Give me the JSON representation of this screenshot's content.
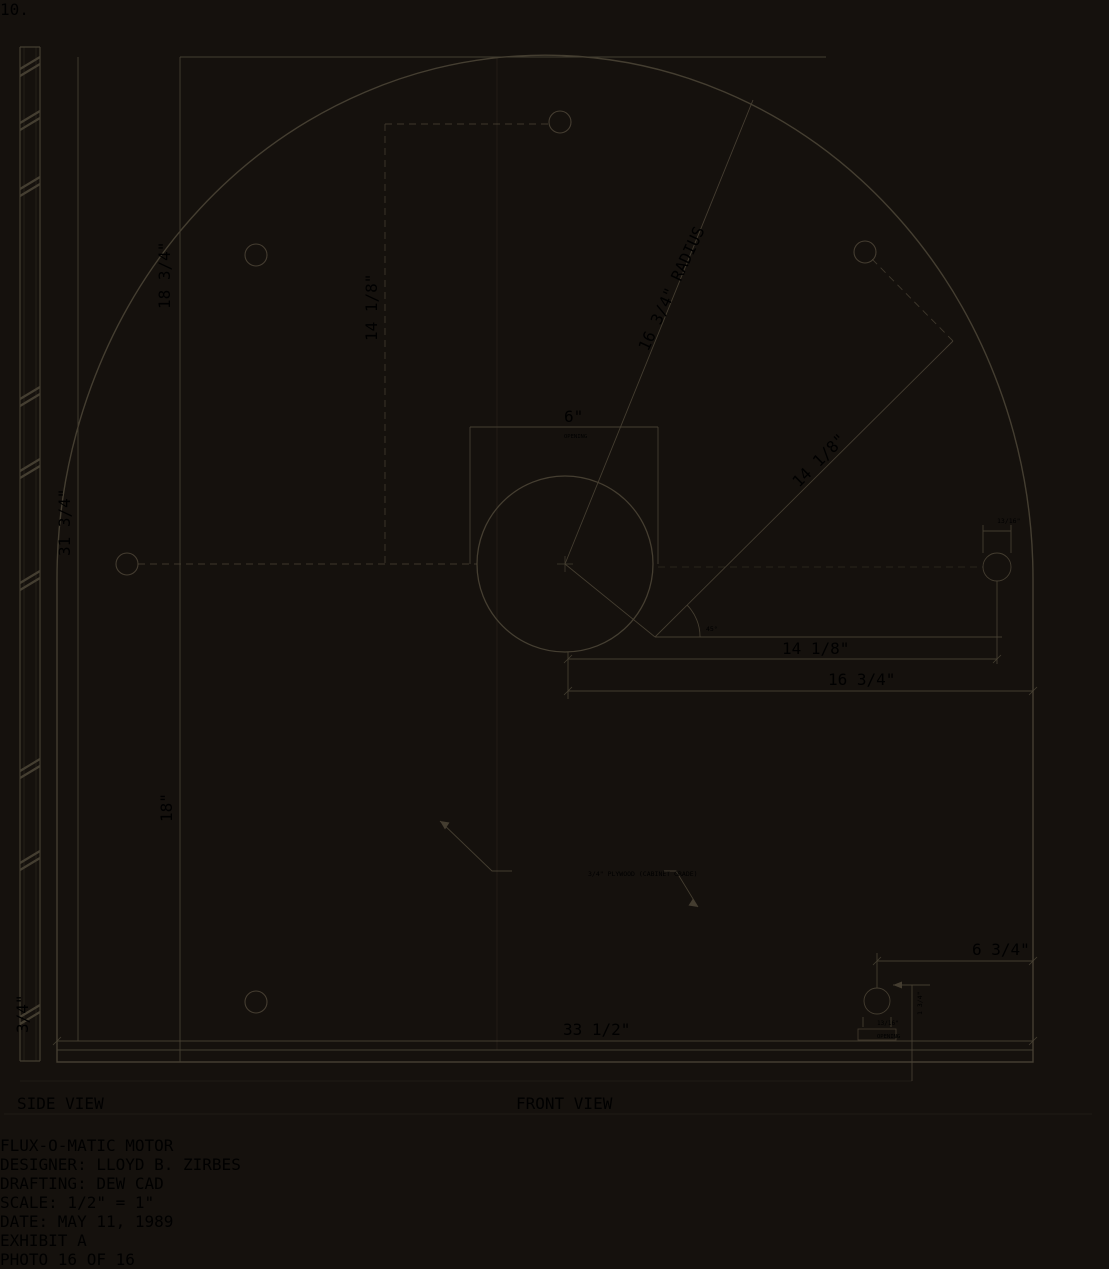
{
  "photo": {
    "paper_color": "#c9c2b0",
    "ink_color": "#4a4335"
  },
  "annotations": {
    "page_number": "10."
  },
  "title_block": {
    "rows": [
      "FLUX-O-MATIC MOTOR",
      "DESIGNER: LLOYD B. ZIRBES",
      "DRAFTING: DEW CAD",
      "SCALE: 1/2\" = 1\"",
      "DATE: MAY 11, 1989"
    ],
    "exhibit": "EXHIBIT A"
  },
  "views": {
    "side_label": "SIDE VIEW",
    "front_label": "FRONT VIEW"
  },
  "dims": {
    "top_height": "18 3/4\"",
    "upper_drop": "14 1/8\"",
    "radius": "16 3/4\" RADIUS",
    "opening_width": "6\"",
    "opening_word": "OPENING",
    "diag_offset": "14 1/8\"",
    "right_hole": "13/16\"",
    "left_height": "31 3/4\"",
    "angle": "45°",
    "h_offset1": "14 1/8\"",
    "h_offset2": "16 3/4\"",
    "lower_left": "18\"",
    "material_note": "3/4\" PLYWOOD (CABINET GRADE)",
    "bottom_offset": "6 3/4\"",
    "bottom_hole": "13/16\"",
    "bottom_hole_word": "OPENING",
    "edge_offset": "1 3/4\"",
    "overall_width": "33 1/2\"",
    "thickness": "3/4\""
  },
  "footer": {
    "handwritten_note": "PHOTO 16 OF 16"
  }
}
